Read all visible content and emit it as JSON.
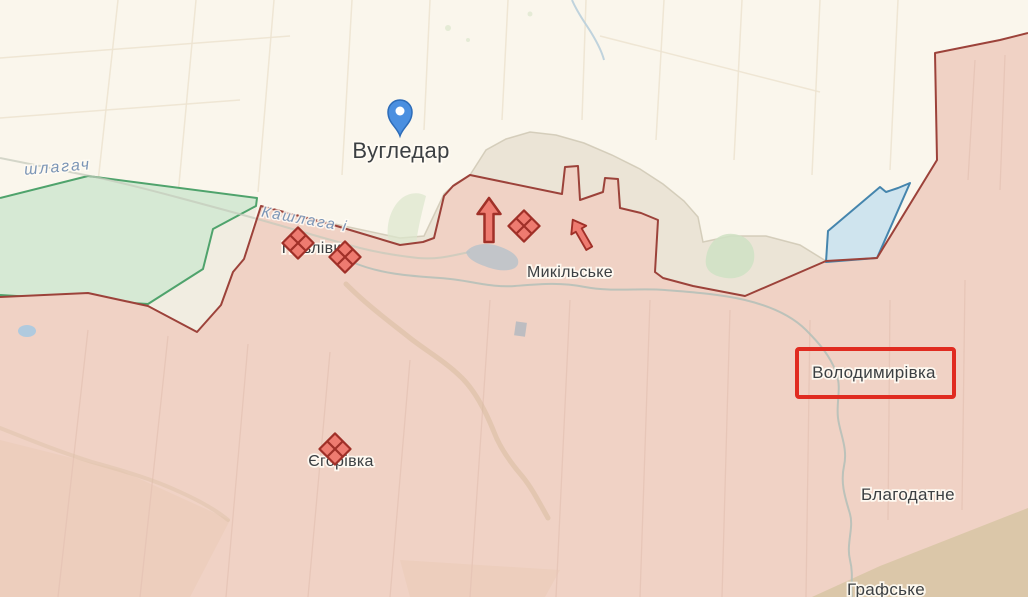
{
  "map": {
    "description": "frontline map around Vuhledar",
    "colors": {
      "base": "#faf6ec",
      "occupied_fill": "#f0d2c5",
      "occupied_border": "#9c423a",
      "liberated_fill": "#d6e9d4",
      "liberated_border": "#4fa36c",
      "contested_fill": "#e9e2d4",
      "water_fill": "#cfe4ee",
      "water_border": "#4585ad",
      "highlight_red": "#e02b20",
      "pin_blue": "#4a8fe0",
      "marker_fill": "#ee7b70",
      "marker_border": "#a03028",
      "label_color": "#3c4043",
      "water_label_color": "#7b95b6"
    },
    "place_labels": [
      {
        "id": "vuhledar",
        "text": "Вугледар",
        "x": 401,
        "y": 158,
        "size": 22
      },
      {
        "id": "pavlivka",
        "text": "Павлівка",
        "x": 316,
        "y": 253,
        "size": 16
      },
      {
        "id": "mykilske",
        "text": "Микільське",
        "x": 570,
        "y": 277,
        "size": 16
      },
      {
        "id": "volodymyrivka",
        "text": "Володимирівка",
        "x": 874,
        "y": 378,
        "size": 17
      },
      {
        "id": "yehorivka",
        "text": "Єгорівка",
        "x": 341,
        "y": 466,
        "size": 16
      },
      {
        "id": "blahodatne",
        "text": "Благодатне",
        "x": 908,
        "y": 500,
        "size": 17
      },
      {
        "id": "hrafske",
        "text": "Графське",
        "x": 886,
        "y": 595,
        "size": 17
      }
    ],
    "water_labels": [
      {
        "id": "kashlahach-west",
        "text": "шлагач",
        "x": 58,
        "y": 172,
        "rotate": -5,
        "size": 16
      },
      {
        "id": "kashlaha",
        "text": "Кашлага і",
        "x": 304,
        "y": 224,
        "rotate": 10,
        "size": 15
      }
    ],
    "pin": {
      "id": "vuhledar-pin",
      "x": 400,
      "y": 136
    },
    "highlight_box": {
      "x": 797,
      "y": 349,
      "width": 157,
      "height": 48
    },
    "clash_markers": [
      {
        "x": 298,
        "y": 243
      },
      {
        "x": 345,
        "y": 257
      },
      {
        "x": 524,
        "y": 226
      },
      {
        "x": 335,
        "y": 449
      }
    ],
    "attack_arrows": [
      {
        "x": 489,
        "y": 220,
        "rotate": 0,
        "scale": 1
      },
      {
        "x": 581,
        "y": 234,
        "rotate": -30,
        "scale": 0.75
      }
    ]
  }
}
